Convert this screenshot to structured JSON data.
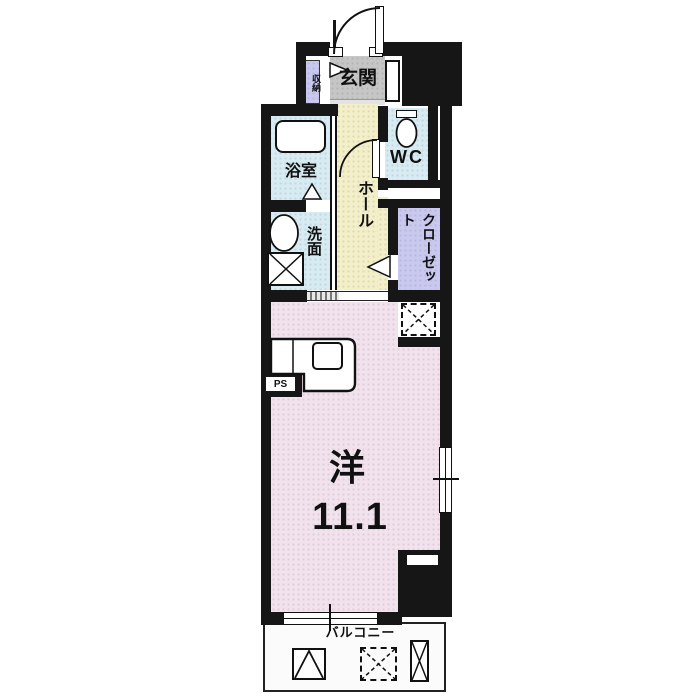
{
  "floor_plan": {
    "unit_labels": {
      "entrance": "玄関",
      "entrance_storage": "収納",
      "bathroom": "浴室",
      "washroom": "洗面",
      "toilet": "WC",
      "hall": "ホール",
      "closet": "クローゼット",
      "pipe_space": "PS",
      "main_room_type": "洋",
      "main_room_size": "11.1",
      "balcony": "バルコニー"
    },
    "colors": {
      "wall": "#161616",
      "room-pink": "#F2E2ED",
      "hall-yellow": "#F3EFC8",
      "water-blue": "#D7EBF3",
      "closet-lavender": "#C9C9EF",
      "entrance-gray": "#C6C6C6",
      "balcony-white": "#FBFBFB"
    },
    "icons": [
      "entrance-door-swing-icon",
      "wc-door-swing-icon",
      "folding-door-marker-icon",
      "bathtub-icon",
      "toilet-icon",
      "sink-icon",
      "washing-machine-space-icon",
      "refrigerator-space-icon",
      "kitchen-counter-icon",
      "stove-icon",
      "window-icon",
      "evacuation-hatch-icon",
      "partition-board-icon"
    ]
  }
}
